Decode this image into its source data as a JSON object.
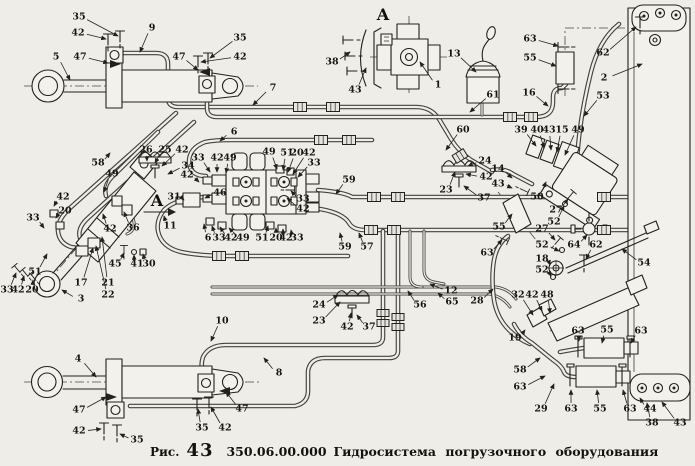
{
  "figure": {
    "fig_label": "Рис.",
    "fig_number": "43",
    "doc_code": "350.06.00.000",
    "title": "Гидросистема  погрузочного  оборудования",
    "background_color": "#efede8",
    "ink_color": "#23211e"
  },
  "view_letters": [
    {
      "text": "А",
      "x": 383,
      "y": 14,
      "arrow": false
    },
    {
      "text": "А",
      "x": 157,
      "y": 200,
      "arrow": true
    }
  ],
  "part_labels": [
    {
      "t": "35",
      "x": 79,
      "y": 17,
      "lx": 118,
      "ly": 36
    },
    {
      "t": "42",
      "x": 78,
      "y": 33,
      "lx": 106,
      "ly": 39
    },
    {
      "t": "9",
      "x": 152,
      "y": 28,
      "lx": 140,
      "ly": 52
    },
    {
      "t": "47",
      "x": 80,
      "y": 57,
      "lx": 108,
      "ly": 63
    },
    {
      "t": "5",
      "x": 56,
      "y": 57,
      "lx": 70,
      "ly": 80
    },
    {
      "t": "47",
      "x": 179,
      "y": 57,
      "lx": 198,
      "ly": 70
    },
    {
      "t": "35",
      "x": 240,
      "y": 38,
      "lx": 210,
      "ly": 58
    },
    {
      "t": "42",
      "x": 240,
      "y": 57,
      "lx": 201,
      "ly": 62
    },
    {
      "t": "7",
      "x": 273,
      "y": 88,
      "lx": 253,
      "ly": 105
    },
    {
      "t": "38",
      "x": 332,
      "y": 62,
      "lx": 350,
      "ly": 52
    },
    {
      "t": "43",
      "x": 355,
      "y": 90,
      "lx": 366,
      "ly": 68
    },
    {
      "t": "1",
      "x": 438,
      "y": 85,
      "lx": 420,
      "ly": 62
    },
    {
      "t": "13",
      "x": 454,
      "y": 54,
      "lx": 476,
      "ly": 72
    },
    {
      "t": "63",
      "x": 530,
      "y": 39,
      "lx": 558,
      "ly": 46
    },
    {
      "t": "55",
      "x": 530,
      "y": 58,
      "lx": 556,
      "ly": 66
    },
    {
      "t": "62",
      "x": 603,
      "y": 53,
      "lx": 636,
      "ly": 27
    },
    {
      "t": "2",
      "x": 604,
      "y": 78,
      "lx": 642,
      "ly": 64
    },
    {
      "t": "53",
      "x": 603,
      "y": 96,
      "lx": 584,
      "ly": 116
    },
    {
      "t": "61",
      "x": 493,
      "y": 95,
      "lx": 470,
      "ly": 112
    },
    {
      "t": "16",
      "x": 529,
      "y": 93,
      "lx": 548,
      "ly": 106
    },
    {
      "t": "60",
      "x": 463,
      "y": 130,
      "lx": 446,
      "ly": 150
    },
    {
      "t": "39",
      "x": 521,
      "y": 130,
      "lx": 536,
      "ly": 146
    },
    {
      "t": "40",
      "x": 537,
      "y": 130,
      "lx": 544,
      "ly": 148
    },
    {
      "t": "43",
      "x": 549,
      "y": 130,
      "lx": 551,
      "ly": 150
    },
    {
      "t": "15",
      "x": 562,
      "y": 130,
      "lx": 557,
      "ly": 152
    },
    {
      "t": "49",
      "x": 578,
      "y": 130,
      "lx": 565,
      "ly": 155
    },
    {
      "t": "58",
      "x": 98,
      "y": 163,
      "lx": 110,
      "ly": 153
    },
    {
      "t": "49",
      "x": 112,
      "y": 174,
      "lx": 104,
      "ly": 192
    },
    {
      "t": "42",
      "x": 63,
      "y": 197,
      "lx": 54,
      "ly": 206
    },
    {
      "t": "20",
      "x": 65,
      "y": 211,
      "lx": 56,
      "ly": 218
    },
    {
      "t": "33",
      "x": 33,
      "y": 218,
      "lx": 44,
      "ly": 228
    },
    {
      "t": "42",
      "x": 110,
      "y": 229,
      "lx": 103,
      "ly": 214
    },
    {
      "t": "36",
      "x": 133,
      "y": 228,
      "lx": 124,
      "ly": 212
    },
    {
      "t": "45",
      "x": 115,
      "y": 264,
      "lx": 124,
      "ly": 253
    },
    {
      "t": "41",
      "x": 137,
      "y": 264,
      "lx": 134,
      "ly": 255
    },
    {
      "t": "30",
      "x": 149,
      "y": 264,
      "lx": 143,
      "ly": 254
    },
    {
      "t": "51",
      "x": 35,
      "y": 272,
      "lx": 47,
      "ly": 254
    },
    {
      "t": "17",
      "x": 81,
      "y": 283,
      "lx": 93,
      "ly": 248
    },
    {
      "t": "21",
      "x": 108,
      "y": 283,
      "lx": 102,
      "ly": 237
    },
    {
      "t": "22",
      "x": 108,
      "y": 295,
      "lx": 96,
      "ly": 246
    },
    {
      "t": "3",
      "x": 81,
      "y": 299,
      "lx": 62,
      "ly": 290
    },
    {
      "t": "33",
      "x": 7,
      "y": 290,
      "lx": 16,
      "ly": 273
    },
    {
      "t": "42",
      "x": 18,
      "y": 290,
      "lx": 24,
      "ly": 276
    },
    {
      "t": "20",
      "x": 32,
      "y": 290,
      "lx": 33,
      "ly": 280
    },
    {
      "t": "26",
      "x": 146,
      "y": 150,
      "lx": 147,
      "ly": 161
    },
    {
      "t": "25",
      "x": 165,
      "y": 150,
      "lx": 155,
      "ly": 163
    },
    {
      "t": "42",
      "x": 182,
      "y": 150,
      "lx": 162,
      "ly": 166
    },
    {
      "t": "34",
      "x": 188,
      "y": 166,
      "lx": 168,
      "ly": 174
    },
    {
      "t": "31",
      "x": 174,
      "y": 197,
      "lx": 184,
      "ly": 200
    },
    {
      "t": "46",
      "x": 220,
      "y": 193,
      "lx": 205,
      "ly": 198
    },
    {
      "t": "11",
      "x": 170,
      "y": 226,
      "lx": 164,
      "ly": 216
    },
    {
      "t": "6",
      "x": 234,
      "y": 132,
      "lx": 220,
      "ly": 141
    },
    {
      "t": "33",
      "x": 198,
      "y": 158,
      "lx": 210,
      "ly": 172
    },
    {
      "t": "42",
      "x": 217,
      "y": 158,
      "lx": 217,
      "ly": 172
    },
    {
      "t": "49",
      "x": 230,
      "y": 158,
      "lx": 226,
      "ly": 173
    },
    {
      "t": "49",
      "x": 269,
      "y": 152,
      "lx": 277,
      "ly": 169
    },
    {
      "t": "51",
      "x": 287,
      "y": 153,
      "lx": 283,
      "ly": 170
    },
    {
      "t": "20",
      "x": 297,
      "y": 153,
      "lx": 288,
      "ly": 172
    },
    {
      "t": "42",
      "x": 309,
      "y": 153,
      "lx": 293,
      "ly": 174
    },
    {
      "t": "33",
      "x": 314,
      "y": 163,
      "lx": 298,
      "ly": 177
    },
    {
      "t": "42",
      "x": 187,
      "y": 175,
      "lx": 199,
      "ly": 182
    },
    {
      "t": "33",
      "x": 303,
      "y": 199,
      "lx": 291,
      "ly": 191
    },
    {
      "t": "42",
      "x": 303,
      "y": 209,
      "lx": 287,
      "ly": 198
    },
    {
      "t": "6",
      "x": 208,
      "y": 238,
      "lx": 204,
      "ly": 224
    },
    {
      "t": "33",
      "x": 219,
      "y": 238,
      "lx": 212,
      "ly": 226
    },
    {
      "t": "42",
      "x": 231,
      "y": 238,
      "lx": 220,
      "ly": 227
    },
    {
      "t": "49",
      "x": 243,
      "y": 238,
      "lx": 229,
      "ly": 228
    },
    {
      "t": "51",
      "x": 262,
      "y": 238,
      "lx": 268,
      "ly": 226
    },
    {
      "t": "20",
      "x": 276,
      "y": 238,
      "lx": 276,
      "ly": 228
    },
    {
      "t": "42",
      "x": 286,
      "y": 238,
      "lx": 283,
      "ly": 229
    },
    {
      "t": "33",
      "x": 297,
      "y": 238,
      "lx": 291,
      "ly": 230
    },
    {
      "t": "59",
      "x": 349,
      "y": 180,
      "lx": 336,
      "ly": 194
    },
    {
      "t": "59",
      "x": 345,
      "y": 247,
      "lx": 340,
      "ly": 233
    },
    {
      "t": "57",
      "x": 367,
      "y": 247,
      "lx": 359,
      "ly": 233
    },
    {
      "t": "12",
      "x": 451,
      "y": 291,
      "lx": 430,
      "ly": 284
    },
    {
      "t": "65",
      "x": 452,
      "y": 302,
      "lx": 438,
      "ly": 293
    },
    {
      "t": "56",
      "x": 420,
      "y": 305,
      "lx": 408,
      "ly": 291
    },
    {
      "t": "24",
      "x": 485,
      "y": 161,
      "lx": 468,
      "ly": 166
    },
    {
      "t": "14",
      "x": 498,
      "y": 169,
      "lx": 512,
      "ly": 178
    },
    {
      "t": "42",
      "x": 486,
      "y": 177,
      "lx": 466,
      "ly": 174
    },
    {
      "t": "23",
      "x": 446,
      "y": 190,
      "lx": 455,
      "ly": 172
    },
    {
      "t": "43",
      "x": 498,
      "y": 184,
      "lx": 512,
      "ly": 188
    },
    {
      "t": "37",
      "x": 484,
      "y": 198,
      "lx": 464,
      "ly": 186
    },
    {
      "t": "50",
      "x": 537,
      "y": 197,
      "lx": 546,
      "ly": 182
    },
    {
      "t": "55",
      "x": 499,
      "y": 227,
      "lx": 512,
      "ly": 214
    },
    {
      "t": "63",
      "x": 487,
      "y": 253,
      "lx": 502,
      "ly": 240
    },
    {
      "t": "27",
      "x": 556,
      "y": 210,
      "lx": 568,
      "ly": 199
    },
    {
      "t": "52",
      "x": 554,
      "y": 222,
      "lx": 564,
      "ly": 206
    },
    {
      "t": "27",
      "x": 542,
      "y": 229,
      "lx": 555,
      "ly": 240
    },
    {
      "t": "52",
      "x": 542,
      "y": 245,
      "lx": 559,
      "ly": 251
    },
    {
      "t": "64",
      "x": 574,
      "y": 245,
      "lx": 587,
      "ly": 235
    },
    {
      "t": "62",
      "x": 596,
      "y": 245,
      "lx": 586,
      "ly": 259
    },
    {
      "t": "18",
      "x": 542,
      "y": 259,
      "lx": 550,
      "ly": 265
    },
    {
      "t": "52",
      "x": 542,
      "y": 270,
      "lx": 551,
      "ly": 276
    },
    {
      "t": "54",
      "x": 644,
      "y": 263,
      "lx": 622,
      "ly": 249
    },
    {
      "t": "28",
      "x": 477,
      "y": 301,
      "lx": 493,
      "ly": 289
    },
    {
      "t": "32",
      "x": 518,
      "y": 295,
      "lx": 533,
      "ly": 315
    },
    {
      "t": "42",
      "x": 532,
      "y": 295,
      "lx": 542,
      "ly": 311
    },
    {
      "t": "48",
      "x": 547,
      "y": 295,
      "lx": 550,
      "ly": 313
    },
    {
      "t": "19",
      "x": 515,
      "y": 338,
      "lx": 525,
      "ly": 330
    },
    {
      "t": "63",
      "x": 578,
      "y": 331,
      "lx": 579,
      "ly": 341
    },
    {
      "t": "55",
      "x": 607,
      "y": 330,
      "lx": 602,
      "ly": 343
    },
    {
      "t": "63",
      "x": 641,
      "y": 331,
      "lx": 631,
      "ly": 343
    },
    {
      "t": "58",
      "x": 520,
      "y": 370,
      "lx": 540,
      "ly": 358
    },
    {
      "t": "63",
      "x": 520,
      "y": 387,
      "lx": 545,
      "ly": 376
    },
    {
      "t": "29",
      "x": 541,
      "y": 409,
      "lx": 554,
      "ly": 384
    },
    {
      "t": "63",
      "x": 571,
      "y": 409,
      "lx": 571,
      "ly": 390
    },
    {
      "t": "55",
      "x": 600,
      "y": 409,
      "lx": 597,
      "ly": 390
    },
    {
      "t": "63",
      "x": 630,
      "y": 409,
      "lx": 623,
      "ly": 390
    },
    {
      "t": "44",
      "x": 650,
      "y": 409,
      "lx": 640,
      "ly": 398
    },
    {
      "t": "38",
      "x": 652,
      "y": 423,
      "lx": 647,
      "ly": 403
    },
    {
      "t": "43",
      "x": 680,
      "y": 423,
      "lx": 662,
      "ly": 402
    },
    {
      "t": "4",
      "x": 78,
      "y": 359,
      "lx": 96,
      "ly": 377
    },
    {
      "t": "10",
      "x": 222,
      "y": 321,
      "lx": 211,
      "ly": 341
    },
    {
      "t": "47",
      "x": 79,
      "y": 410,
      "lx": 106,
      "ly": 397
    },
    {
      "t": "42",
      "x": 79,
      "y": 431,
      "lx": 101,
      "ly": 429
    },
    {
      "t": "35",
      "x": 137,
      "y": 440,
      "lx": 120,
      "ly": 434
    },
    {
      "t": "35",
      "x": 202,
      "y": 428,
      "lx": 198,
      "ly": 409
    },
    {
      "t": "42",
      "x": 225,
      "y": 428,
      "lx": 211,
      "ly": 407
    },
    {
      "t": "47",
      "x": 242,
      "y": 409,
      "lx": 226,
      "ly": 392
    },
    {
      "t": "8",
      "x": 279,
      "y": 373,
      "lx": 264,
      "ly": 358
    },
    {
      "t": "24",
      "x": 319,
      "y": 305,
      "lx": 338,
      "ly": 295
    },
    {
      "t": "23",
      "x": 319,
      "y": 321,
      "lx": 340,
      "ly": 302
    },
    {
      "t": "42",
      "x": 347,
      "y": 327,
      "lx": 351,
      "ly": 313
    },
    {
      "t": "37",
      "x": 369,
      "y": 327,
      "lx": 357,
      "ly": 315
    }
  ]
}
